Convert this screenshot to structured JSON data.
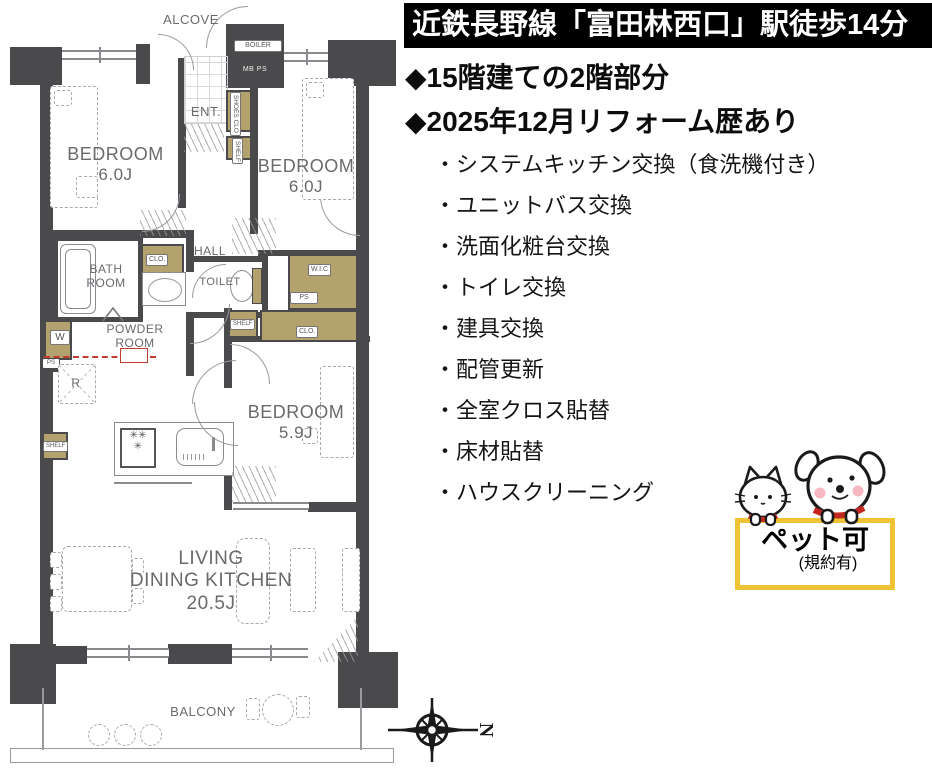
{
  "banner": {
    "text": "近鉄長野線「富田林西口」駅徒歩14分",
    "bg_color": "#000000",
    "text_color": "#ffffff"
  },
  "highlights": [
    "◆15階建ての2階部分",
    "◆2025年12月リフォーム歴あり"
  ],
  "ui": {
    "bullet": "・"
  },
  "reform_items": [
    "システムキッチン交換（食洗機付き）",
    "ユニットバス交換",
    "洗面化粧台交換",
    "トイレ交換",
    "建具交換",
    "配管更新",
    "全室クロス貼替",
    "床材貼替",
    "ハウスクリーニング"
  ],
  "pet_box": {
    "title": "ペット可",
    "subtitle": "(規約有)",
    "border_color": "#f0c235"
  },
  "floorplan": {
    "alcove": "ALCOVE",
    "ent": "ENT.",
    "hall": "HALL",
    "toilet": "TOILET",
    "bath_line1": "BATH",
    "bath_line2": "ROOM",
    "powder_line1": "POWDER",
    "powder_line2": "ROOM",
    "bedroom1_name": "BEDROOM",
    "bedroom1_size": "6.0J",
    "bedroom2_name": "BEDROOM",
    "bedroom2_size": "6.0J",
    "bedroom3_name": "BEDROOM",
    "bedroom3_size": "5.9J",
    "ldk_line1": "LIVING",
    "ldk_line2": "DINING KITCHEN",
    "ldk_size": "20.5J",
    "balcony": "BALCONY",
    "boiler": "BOILER",
    "mb_ps": "MB  PS",
    "shoes": "SHOES",
    "clo_short": "CLO",
    "clo": "CLO.",
    "shelf": "SHELF",
    "wic": "W.I.C",
    "ps": "PS",
    "washer": "W",
    "fridge": "R",
    "compass_north": "N",
    "colors": {
      "wall": "#4a4a4c",
      "closet_fill": "#b3a26d",
      "renovation_line_red": "#c23b2e"
    }
  }
}
